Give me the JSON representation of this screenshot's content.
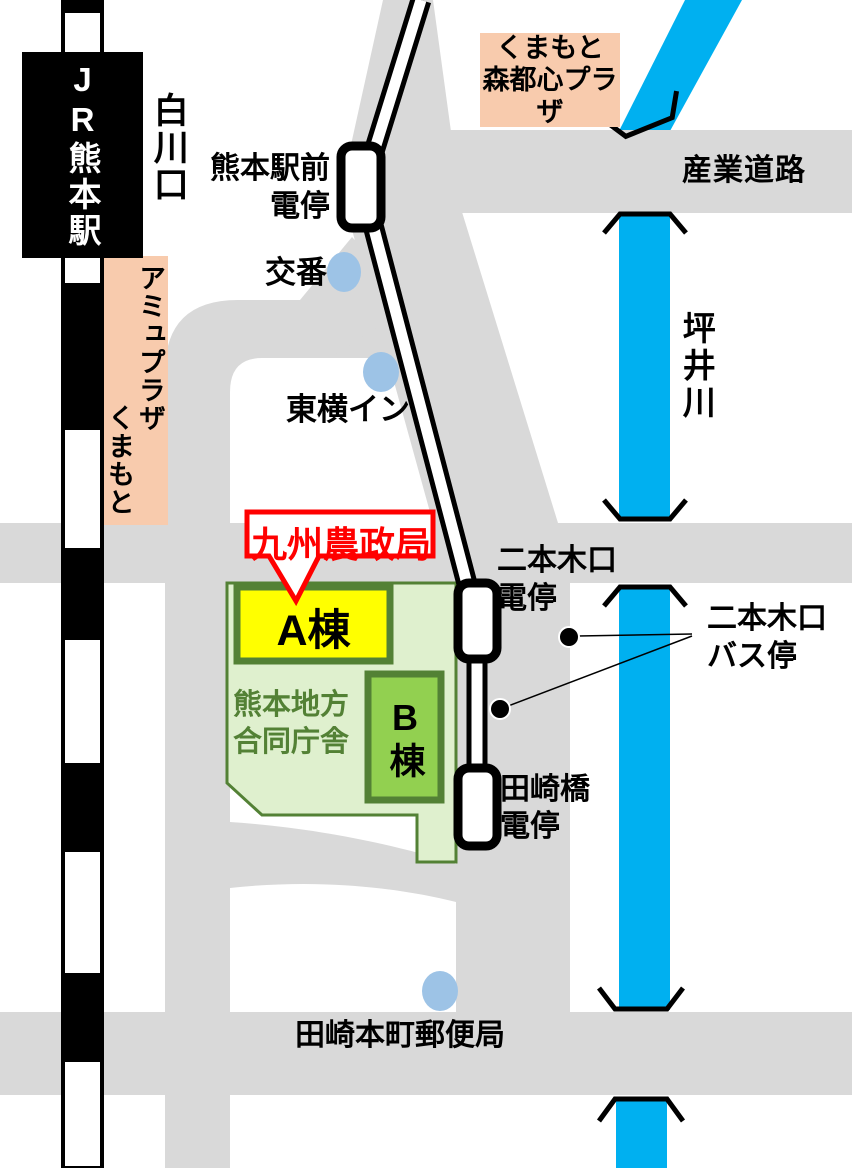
{
  "colors": {
    "road_gray": "#D9D9D9",
    "river_blue": "#00B0F0",
    "site_fill": "#DFF0CE",
    "site_border": "#538135",
    "building_a_fill": "#FFFF00",
    "building_b_fill": "#92D050",
    "landmark_orange": "#F8CBAD",
    "poi_dot_blue": "#9DC3E6",
    "highlight_red": "#FF0000",
    "rail_black": "#000000"
  },
  "labels": {
    "jr_station": "JR熊本駅",
    "exit": "白川口",
    "amu_plaza_line1": "アミュプラザ",
    "amu_plaza_line2": "くまもと",
    "shintoshin_line1": "くまもと",
    "shintoshin_line2": "森都心プラザ",
    "sangyo_road": "産業道路",
    "tsuboi_river": "坪井川",
    "ekimae_stop_line1": "熊本駅前",
    "ekimae_stop_line2": "電停",
    "koban": "交番",
    "toyoko_inn": "東横イン",
    "agency_callout": "九州農政局",
    "building_a": "A棟",
    "building_b": "B棟",
    "gov_complex_line1": "熊本地方",
    "gov_complex_line2": "合同庁舎",
    "nihongiguchi_stop_line1": "二本木口",
    "nihongiguchi_stop_line2": "電停",
    "nihongiguchi_bus_line1": "二本木口",
    "nihongiguchi_bus_line2": "バス停",
    "tasakibashi_stop_line1": "田崎橋",
    "tasakibashi_stop_line2": "電停",
    "post_office": "田崎本町郵便局"
  }
}
